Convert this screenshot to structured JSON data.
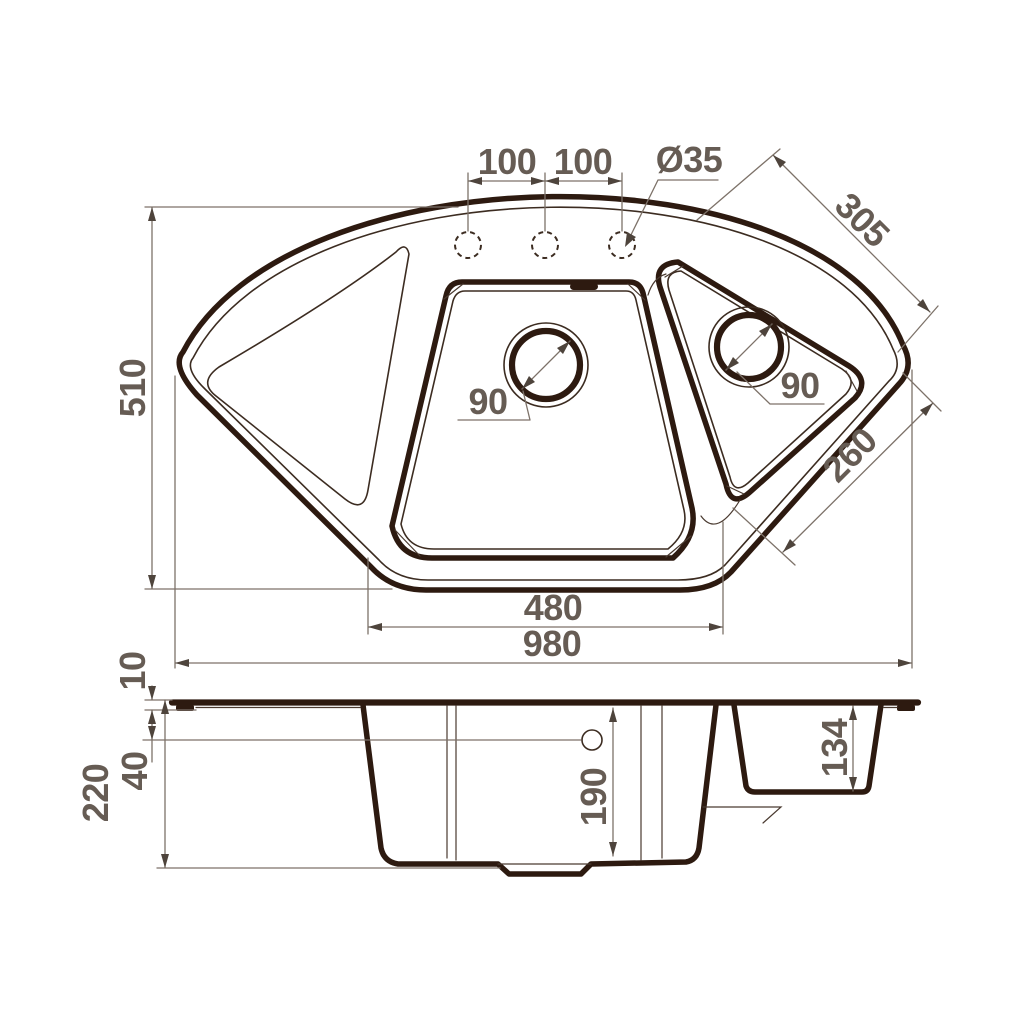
{
  "drawing": {
    "top_view": {
      "hole_spacing_left": "100",
      "hole_spacing_right": "100",
      "hole_diameter": "Ø35",
      "edge_right_top": "305",
      "overall_depth": "510",
      "main_drain_diameter": "90",
      "right_drain_diameter": "90",
      "edge_right_bottom": "260",
      "bottom_width": "480",
      "overall_width": "980"
    },
    "section_view": {
      "rim_height": "10",
      "overflow_offset": "40",
      "overall_height": "220",
      "main_bowl_depth": "190",
      "right_bowl_depth": "134"
    },
    "colors": {
      "line": "#2d1a10",
      "dimension": "#7d7269",
      "text": "#665c54",
      "background": "#ffffff"
    }
  }
}
